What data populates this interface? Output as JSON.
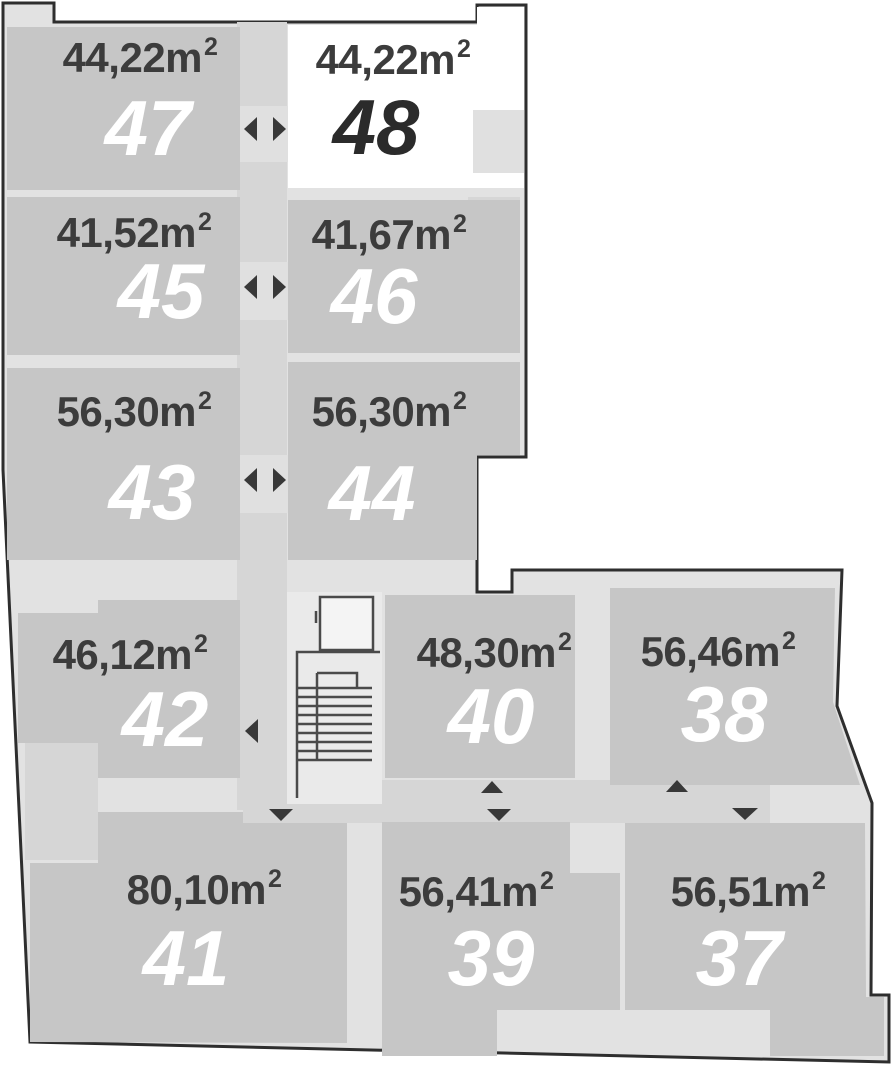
{
  "plan_title": "apartment-floor-plan",
  "selected_unit": "48",
  "area_superscript": "2",
  "units": [
    {
      "id": "unit-47",
      "number": "47",
      "area_label": "44,22m",
      "highlighted": false
    },
    {
      "id": "unit-48",
      "number": "48",
      "area_label": "44,22m",
      "highlighted": true
    },
    {
      "id": "unit-45",
      "number": "45",
      "area_label": "41,52m",
      "highlighted": false
    },
    {
      "id": "unit-46",
      "number": "46",
      "area_label": "41,67m",
      "highlighted": false
    },
    {
      "id": "unit-43",
      "number": "43",
      "area_label": "56,30m",
      "highlighted": false
    },
    {
      "id": "unit-44",
      "number": "44",
      "area_label": "56,30m",
      "highlighted": false
    },
    {
      "id": "unit-42",
      "number": "42",
      "area_label": "46,12m",
      "highlighted": false
    },
    {
      "id": "unit-40",
      "number": "40",
      "area_label": "48,30m",
      "highlighted": false
    },
    {
      "id": "unit-38",
      "number": "38",
      "area_label": "56,46m",
      "highlighted": false
    },
    {
      "id": "unit-41",
      "number": "41",
      "area_label": "80,10m",
      "highlighted": false
    },
    {
      "id": "unit-39",
      "number": "39",
      "area_label": "56,41m",
      "highlighted": false
    },
    {
      "id": "unit-37",
      "number": "37",
      "area_label": "56,51m",
      "highlighted": false
    }
  ],
  "icons": {
    "entrance_left": "left-pointing-triangle",
    "entrance_right": "right-pointing-triangle",
    "entrance_up": "up-pointing-triangle",
    "entrance_down": "down-pointing-triangle",
    "stairs": "stair-treads",
    "elevator": "elevator-shaft-square"
  },
  "colors": {
    "background": "#ffffff",
    "floor_fill": "#e2e2e2",
    "unit_fill": "#c6c6c6",
    "corridor_fill": "#d6d6d6",
    "door_zone_fill": "#e0e0e0",
    "stairwell_fill": "#eaeaea",
    "selected_unit_fill": "#ffffff",
    "outline": "#2e2e2e",
    "area_text": "#3c3c3c",
    "number_text": "#ffffff",
    "selected_number_text": "#2b2b2b",
    "arrow": "#383838"
  }
}
